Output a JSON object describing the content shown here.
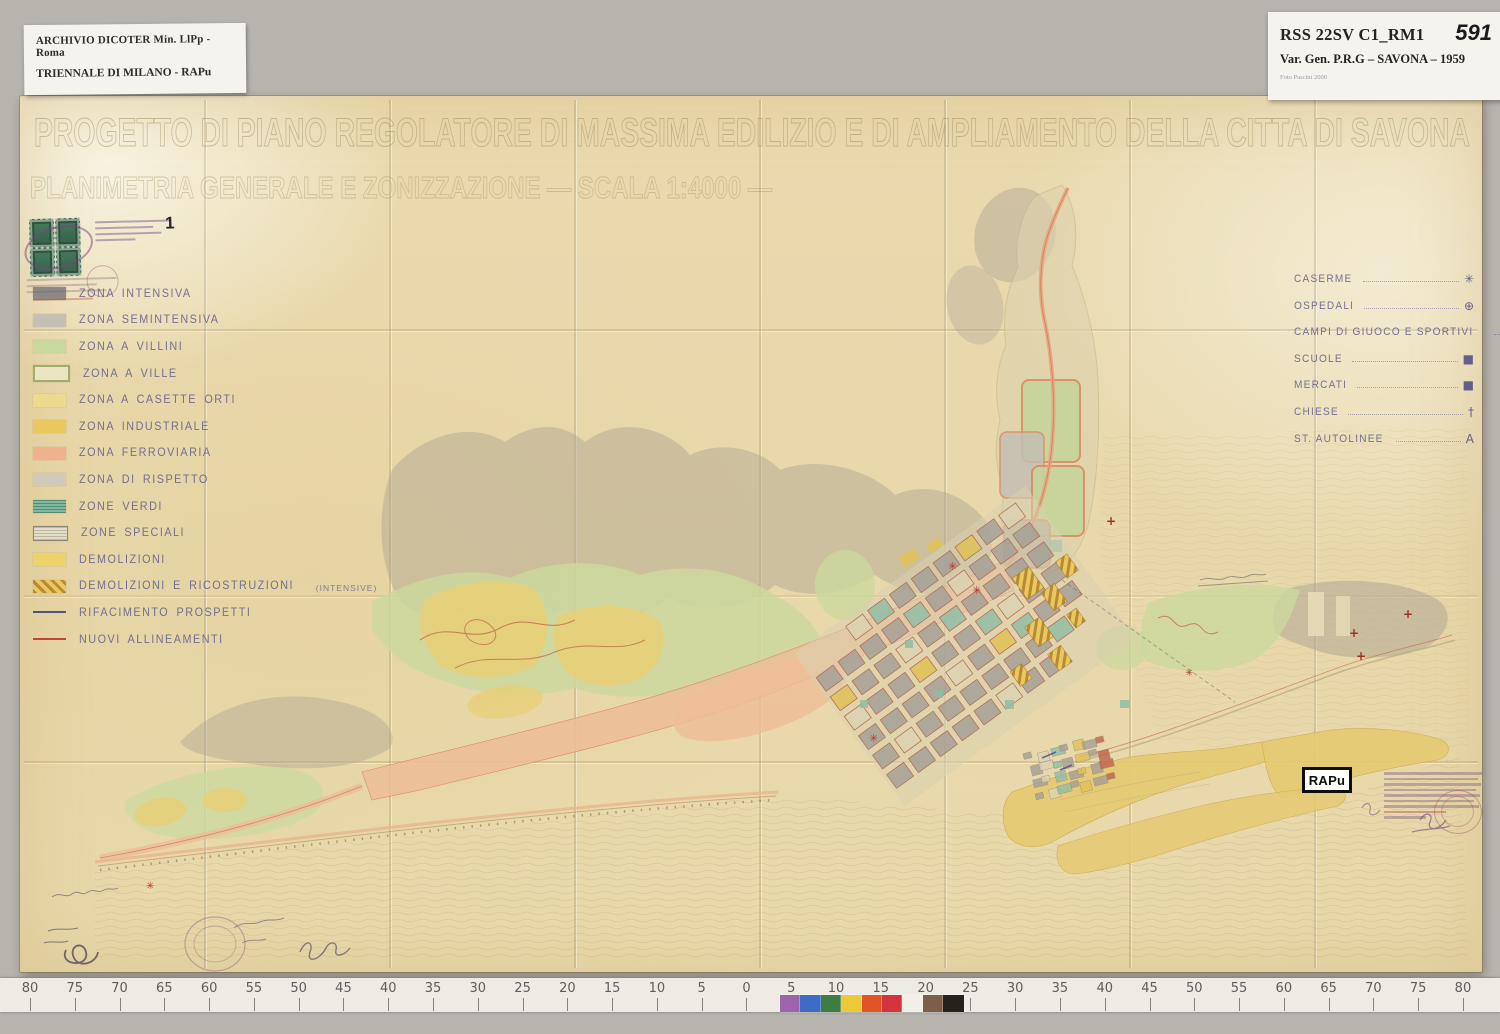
{
  "archive_label_left": {
    "line1": "ARCHIVIO DICOTER Min. LlPp - Roma",
    "line2": "TRIENNALE DI MILANO - RAPu"
  },
  "archive_label_right": {
    "code": "RSS 22SV C1_RM1",
    "number": "591",
    "title": "Var. Gen. P.R.G – SAVONA – 1959",
    "photo_credit": "Foto Pascini 2000"
  },
  "map": {
    "title_line1": "PROGETTO DI PIANO REGOLATORE DI MASSIMA EDILIZIO E DI AMPLIAMENTO DELLA CITTA DI SAVONA",
    "title_line2": "PLANIMETRIA GENERALE E ZONIZZAZIONE — SCALA 1:4000 —",
    "stamp_number": "1",
    "rapu_tag": "RAPu"
  },
  "legend_zones": [
    {
      "label": "ZONA INTENSIVA",
      "style": "solid",
      "color": "#8d8a85"
    },
    {
      "label": "ZONA SEMINTENSIVA",
      "style": "solid",
      "color": "#c5c0b5"
    },
    {
      "label": "ZONA A VILLINI",
      "style": "solid",
      "color": "#c9d79e"
    },
    {
      "label": "ZONA A VILLE",
      "style": "outline",
      "color": "#ece5c4",
      "border": "#9fae6d"
    },
    {
      "label": "ZONA A CASETTE ORTI",
      "style": "solid",
      "color": "#ecd98b"
    },
    {
      "label": "ZONA INDUSTRIALE",
      "style": "solid",
      "color": "#e9c95e"
    },
    {
      "label": "ZONA FERROVIARIA",
      "style": "solid",
      "color": "#efb28c"
    },
    {
      "label": "ZONA DI RISPETTO",
      "style": "solid",
      "color": "#cfcaba"
    },
    {
      "label": "ZONE VERDI",
      "style": "hatch-green",
      "color": "#7fb99e"
    },
    {
      "label": "ZONE SPECIALI",
      "style": "outline-hatch",
      "color": "#e3dcc6",
      "border": "#8d897d"
    },
    {
      "label": "DEMOLIZIONI",
      "style": "solid",
      "color": "#eed36a"
    },
    {
      "label": "DEMOLIZIONI E RICOSTRUZIONI",
      "suffix": "(INTENSIVE)",
      "style": "diag-hatch",
      "color": "#e8c95f",
      "hatch": "#b98a33"
    },
    {
      "label": "RIFACIMENTO PROSPETTI",
      "style": "line",
      "color": "#55517f"
    },
    {
      "label": "NUOVI ALLINEAMENTI",
      "style": "line",
      "color": "#c24536"
    }
  ],
  "legend_symbols": [
    {
      "label": "CASERME",
      "symbol": "✳"
    },
    {
      "label": "OSPEDALI",
      "symbol": "⊕"
    },
    {
      "label": "CAMPI DI GIUOCO E SPORTIVI",
      "symbol": "▶"
    },
    {
      "label": "SCUOLE",
      "symbol": "■"
    },
    {
      "label": "MERCATI",
      "symbol": "■"
    },
    {
      "label": "CHIESE",
      "symbol": "†"
    },
    {
      "label": "ST. AUTOLINEE",
      "symbol": "A"
    }
  ],
  "ruler": {
    "numbers": [
      "80",
      "75",
      "70",
      "65",
      "60",
      "55",
      "50",
      "45",
      "40",
      "35",
      "30",
      "25",
      "20",
      "15",
      "10",
      "5",
      "0",
      "5",
      "10",
      "15",
      "20",
      "25",
      "30",
      "35",
      "40",
      "45",
      "50",
      "55",
      "60",
      "65",
      "70",
      "75",
      "80"
    ],
    "patch_colors": [
      "#9b64ad",
      "#3d6cc6",
      "#3e7c42",
      "#edc93a",
      "#e05427",
      "#d63340",
      "#f1efe8",
      "#7c5f48",
      "#27211c"
    ]
  },
  "colors": {
    "paper": "#e8d9ad",
    "zone_gray": "#b1a792",
    "zone_green": "#cbd89e",
    "zone_yellow": "#e7cf78",
    "zone_rail": "#edbd97",
    "zone_teal": "#8fbda6",
    "line_red": "#c2604a",
    "harbor_yellow": "#e6ca72"
  }
}
